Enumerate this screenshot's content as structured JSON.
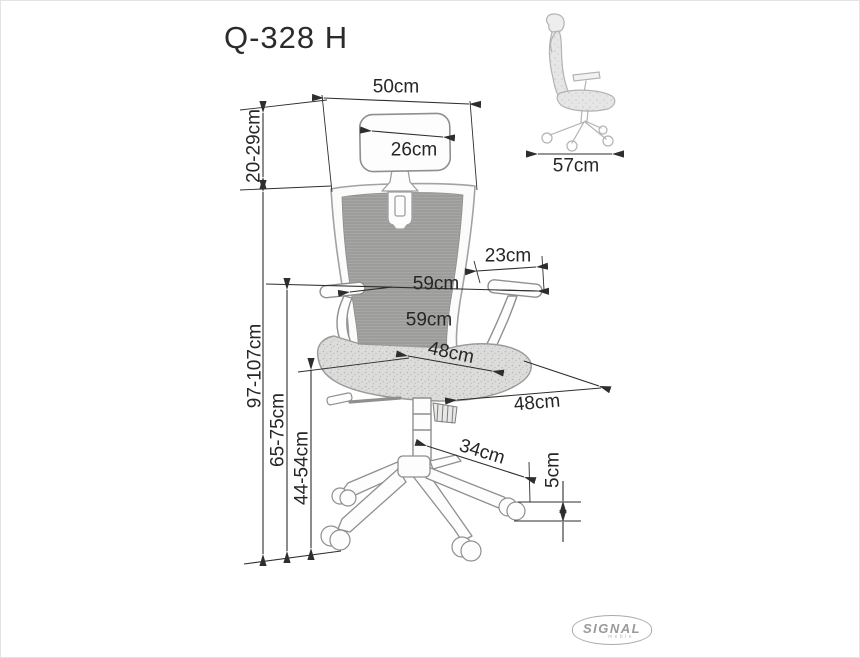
{
  "title": "Q-328 H",
  "brand": {
    "name": "SIGNAL",
    "sub": "meble"
  },
  "colors": {
    "dimension_line": "#2e2e2e",
    "chair_outline": "#949494",
    "mesh_fill": "#a6a6a4",
    "seat_fill": "#dbdbd9",
    "side_view_line": "#b3b3b3",
    "logo_gray": "#9a9a9a"
  },
  "dimensions": {
    "front_view": [
      {
        "id": "backrest-width",
        "label": "50cm"
      },
      {
        "id": "headrest-width",
        "label": "26cm"
      },
      {
        "id": "headrest-height-range",
        "label": "20-29cm"
      },
      {
        "id": "armrest-pad-length",
        "label": "23cm"
      },
      {
        "id": "width-across-armrests",
        "label": "59cm"
      },
      {
        "id": "backrest-lower-width",
        "label": "59cm"
      },
      {
        "id": "seat-width",
        "label": "48cm"
      },
      {
        "id": "seat-depth",
        "label": "48cm"
      },
      {
        "id": "base-leg-span",
        "label": "34cm"
      },
      {
        "id": "caster-height",
        "label": "5cm"
      },
      {
        "id": "total-height-range",
        "label": "97-107cm"
      },
      {
        "id": "armrest-height-range",
        "label": "65-75cm"
      },
      {
        "id": "seat-height-range",
        "label": "44-54cm"
      }
    ],
    "side_view": [
      {
        "id": "overall-depth",
        "label": "57cm"
      }
    ]
  }
}
